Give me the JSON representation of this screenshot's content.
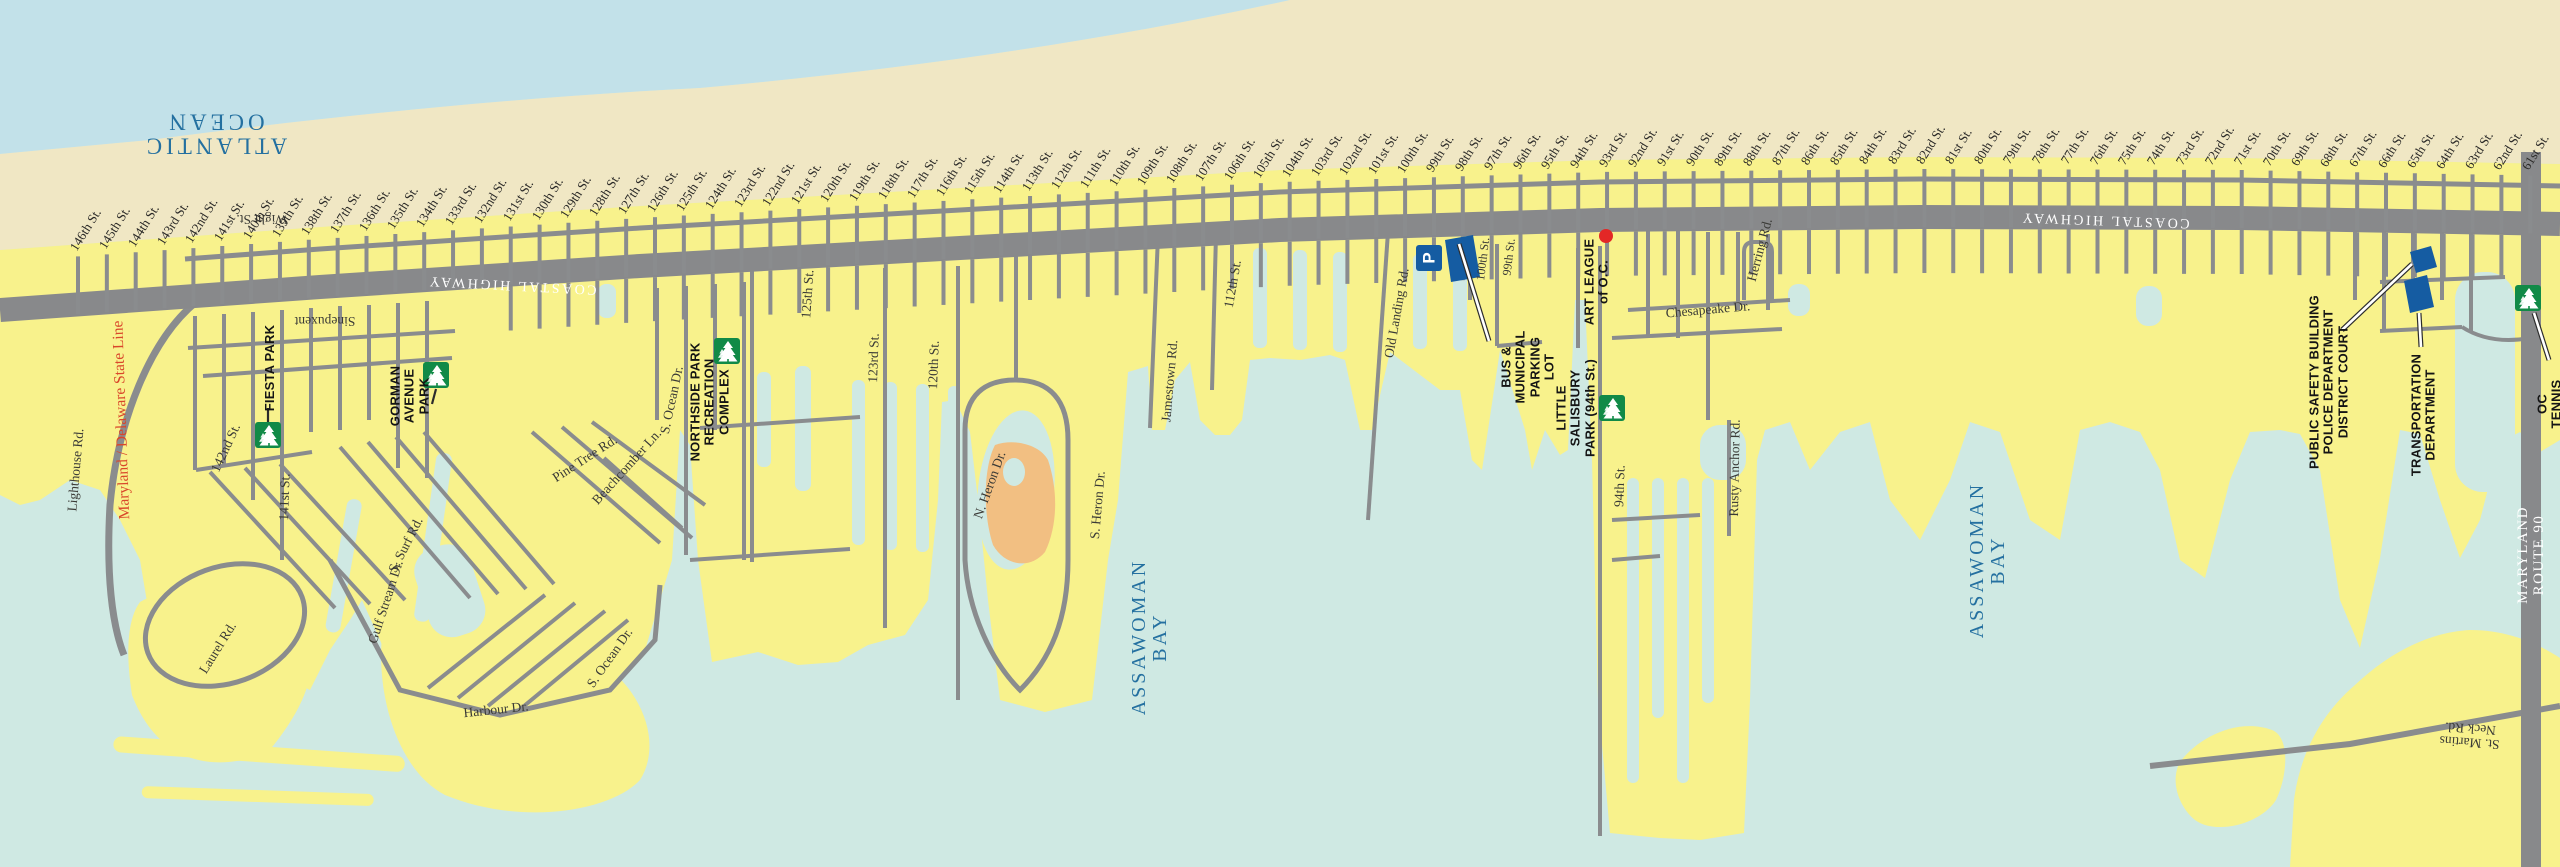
{
  "map_title": "Ocean City north bayside street map",
  "colors": {
    "ocean": "#c2e1e9",
    "bay": "#cfe9e3",
    "beach": "#f0e7c4",
    "land": "#f8f28c",
    "road": "#8a8c8e",
    "highway": "#88898b",
    "park": "#118a47",
    "blue": "#155ca2",
    "red": "#e32726",
    "island": "#f2bf82",
    "watertext": "#2470a0",
    "stateline": "#d9472b"
  },
  "streets": {
    "names": [
      "146th St.",
      "145th St.",
      "144th St.",
      "143rd St.",
      "142nd St.",
      "141st St.",
      "140th St.",
      "139th St.",
      "138th St.",
      "137th St.",
      "136th St.",
      "135th St.",
      "134th St.",
      "133rd St.",
      "132nd St.",
      "131st St.",
      "130th St.",
      "129th St.",
      "128th St.",
      "127th St.",
      "126th St.",
      "125th St.",
      "124th St.",
      "123rd St.",
      "122nd St.",
      "121st St.",
      "120th St.",
      "119th St.",
      "118th St.",
      "117th St.",
      "116th St.",
      "115th St.",
      "114th St.",
      "113th St.",
      "112th St.",
      "111th St.",
      "110th St.",
      "109th St.",
      "108th St.",
      "107th St.",
      "106th St.",
      "105th St.",
      "104th St.",
      "103rd St.",
      "102nd St.",
      "101st St.",
      "100th St.",
      "99th St.",
      "98th St.",
      "97th St.",
      "96th St.",
      "95th St.",
      "94th St.",
      "93rd St.",
      "92nd St.",
      "91st St.",
      "90th St.",
      "89th St.",
      "88th St.",
      "87th St.",
      "86th St.",
      "85th St.",
      "84th St.",
      "83rd St.",
      "82nd St.",
      "81st St.",
      "80th St.",
      "79th St.",
      "78th St.",
      "77th St.",
      "76th St.",
      "75th St.",
      "74th St.",
      "73rd St.",
      "72nd St.",
      "71st St.",
      "70th St.",
      "69th St.",
      "68th St.",
      "67th St.",
      "66th St.",
      "65th St.",
      "64th St.",
      "63rd St.",
      "62nd St.",
      "61st St."
    ]
  },
  "labels": [
    {
      "name": "label-atlantic-ocean",
      "kind": "water-big",
      "text": "ATLANTIC\nOCEAN"
    },
    {
      "name": "label-wight-st",
      "kind": "road",
      "text": "Wight St."
    },
    {
      "name": "label-coastal-highway-west",
      "kind": "hwy",
      "text": "COASTAL HIGHWAY"
    },
    {
      "name": "label-coastal-highway-east",
      "kind": "hwy",
      "text": "COASTAL HIGHWAY"
    },
    {
      "name": "label-sinepuxent",
      "kind": "road",
      "text": "Sinepuxent"
    },
    {
      "name": "label-maryland-delaware-state-line",
      "kind": "stateline",
      "text": "Maryland / Delaware State Line"
    },
    {
      "name": "label-lighthouse-rd",
      "kind": "road",
      "text": "Lighthouse Rd."
    },
    {
      "name": "label-142nd-st",
      "kind": "road",
      "text": "142nd St."
    },
    {
      "name": "label-141st-st",
      "kind": "road",
      "text": "141st St."
    },
    {
      "name": "label-s-surf-rd",
      "kind": "road",
      "text": "S. Surf Rd."
    },
    {
      "name": "label-laurel-rd",
      "kind": "road",
      "text": "Laurel Rd."
    },
    {
      "name": "label-gulf-stream-dr",
      "kind": "road",
      "text": "Gulf Stream Dr."
    },
    {
      "name": "label-s-ocean-dr-upper",
      "kind": "road",
      "text": "S. Ocean Dr."
    },
    {
      "name": "label-s-ocean-dr-lower",
      "kind": "road",
      "text": "S. Ocean Dr."
    },
    {
      "name": "label-harbour-dr",
      "kind": "road",
      "text": "Harbour Dr."
    },
    {
      "name": "label-pine-tree-rd",
      "kind": "road",
      "text": "Pine Tree Rd."
    },
    {
      "name": "label-beachcomber-ln",
      "kind": "road",
      "text": "Beachcomber Ln."
    },
    {
      "name": "label-125th-st-lower",
      "kind": "road",
      "text": "125th St."
    },
    {
      "name": "label-123rd-st-lower",
      "kind": "road",
      "text": "123rd St."
    },
    {
      "name": "label-120th-st-lower",
      "kind": "road",
      "text": "120th St."
    },
    {
      "name": "label-n-heron-dr",
      "kind": "road",
      "text": "N. Heron Dr."
    },
    {
      "name": "label-s-heron-dr",
      "kind": "road",
      "text": "S. Heron Dr."
    },
    {
      "name": "label-jamestown-rd",
      "kind": "road",
      "text": "Jamestown Rd."
    },
    {
      "name": "label-112th-st-lower",
      "kind": "road",
      "text": "112th St."
    },
    {
      "name": "label-old-landing-rd",
      "kind": "road",
      "text": "Old Landing Rd."
    },
    {
      "name": "label-100th-st-lower",
      "kind": "road-sm",
      "text": "100th St."
    },
    {
      "name": "label-99th-st-lower",
      "kind": "road-sm",
      "text": "99th St."
    },
    {
      "name": "label-chesapeake-dr",
      "kind": "road",
      "text": "Chesapeake Dr."
    },
    {
      "name": "label-herring-rd",
      "kind": "road",
      "text": "Herring Rd."
    },
    {
      "name": "label-rusty-anchor-rd",
      "kind": "road",
      "text": "Rusty Anchor Rd."
    },
    {
      "name": "label-94th-st-lower",
      "kind": "road",
      "text": "94th St."
    },
    {
      "name": "label-st-martins-neck-rd",
      "kind": "road",
      "text": "St. Martins Neck Rd."
    },
    {
      "name": "label-assawoman-bay-west",
      "kind": "water",
      "text": "ASSAWOMAN\nBAY"
    },
    {
      "name": "label-assawoman-bay-east",
      "kind": "water",
      "text": "ASSAWOMAN\nBAY"
    },
    {
      "name": "label-maryland-route-90",
      "kind": "route90",
      "text": "MARYLAND ROUTE 90"
    },
    {
      "name": "poi-fiesta-park",
      "kind": "poi",
      "text": "FIESTA PARK"
    },
    {
      "name": "poi-gorman-avenue-park",
      "kind": "poi",
      "text": "GORMAN\nAVENUE\nPARK"
    },
    {
      "name": "poi-northside-park",
      "kind": "poi",
      "text": "NORTHSIDE PARK\nRECREATION\nCOMPLEX"
    },
    {
      "name": "poi-bus-municipal-parking-lot",
      "kind": "poi",
      "text": "BUS &\nMUNICIPAL\nPARKING\nLOT"
    },
    {
      "name": "poi-art-league",
      "kind": "poi",
      "text": "ART LEAGUE\nof O.C."
    },
    {
      "name": "poi-little-salisbury-park",
      "kind": "poi",
      "text": "LITTLE\nSALISBURY\nPARK (94th St.)"
    },
    {
      "name": "poi-public-safety-complex",
      "kind": "poi",
      "text": "PUBLIC SAFETY BUILDING\nPOLICE DEPARTMENT\nDISTRICT COURT"
    },
    {
      "name": "poi-transportation-department",
      "kind": "poi",
      "text": "TRANSPORTATION\nDEPARTMENT"
    },
    {
      "name": "poi-oc-tennis",
      "kind": "poi",
      "text": "OC TENNIS"
    }
  ],
  "icons": [
    {
      "name": "park-icon-fiesta",
      "glyph": "pine-tree"
    },
    {
      "name": "park-icon-gorman",
      "glyph": "pine-tree"
    },
    {
      "name": "park-icon-northside",
      "glyph": "pine-tree"
    },
    {
      "name": "park-icon-little-salisbury",
      "glyph": "pine-tree"
    },
    {
      "name": "park-icon-oc-tennis",
      "glyph": "pine-tree"
    },
    {
      "name": "parking-icon",
      "glyph": "P"
    },
    {
      "name": "art-league-dot",
      "glyph": "red-dot"
    }
  ]
}
